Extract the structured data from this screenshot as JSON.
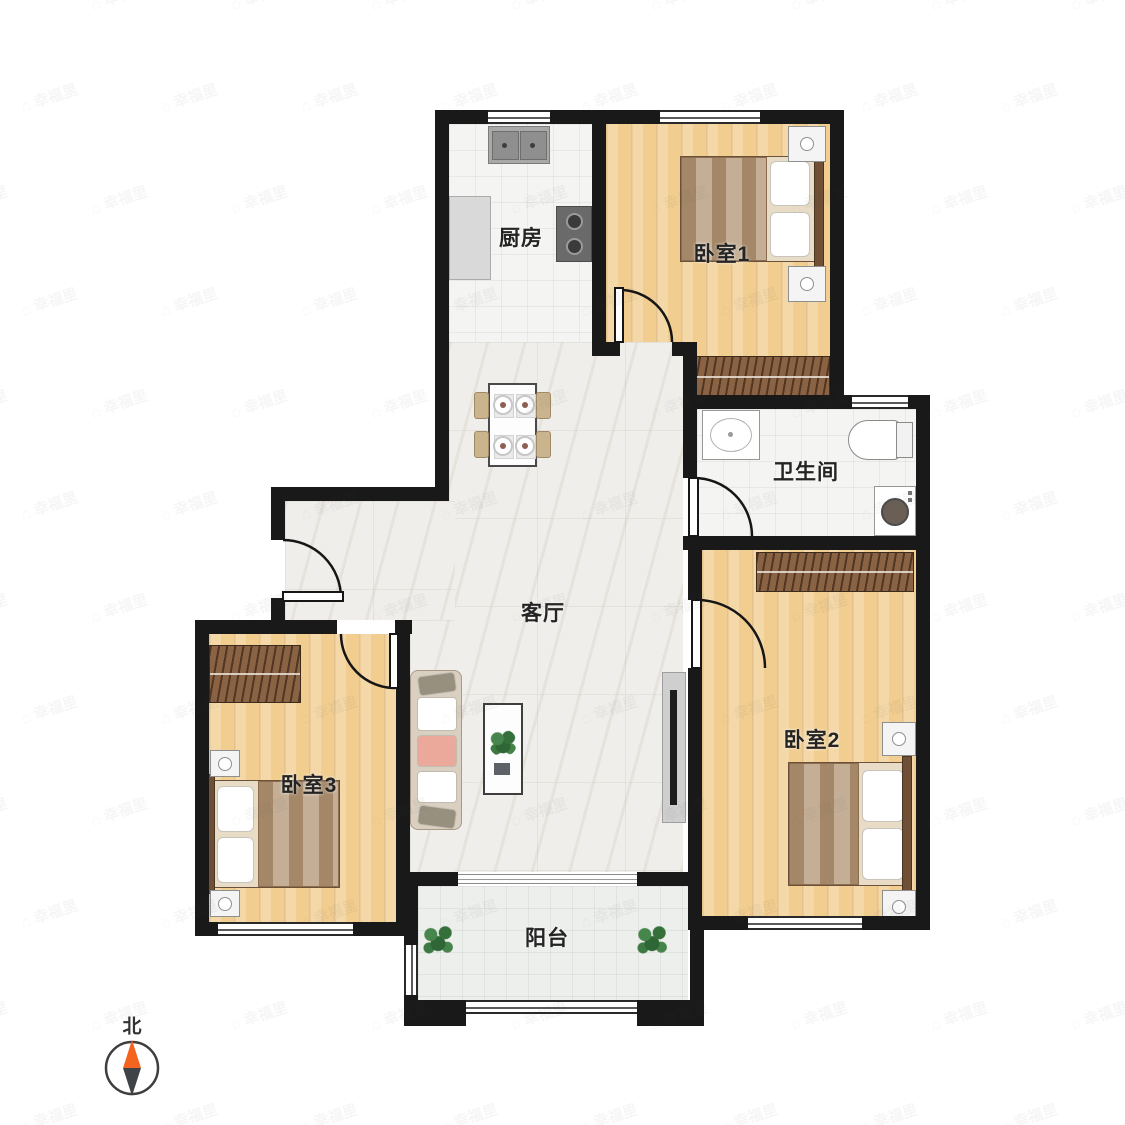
{
  "page": {
    "type": "apartment-floor-plan",
    "background": "#ffffff"
  },
  "watermark": {
    "icon": "⌂",
    "text": "幸福里"
  },
  "compass": {
    "label": "北"
  },
  "rooms": {
    "kitchen": {
      "label": "厨房"
    },
    "bedroom1": {
      "label": "卧室1"
    },
    "bathroom": {
      "label": "卫生间"
    },
    "living_room": {
      "label": "客厅"
    },
    "bedroom2": {
      "label": "卧室2"
    },
    "bedroom3": {
      "label": "卧室3"
    },
    "balcony": {
      "label": "阳台"
    }
  },
  "colors": {
    "wall": "#191919",
    "wood_floor": "#f1cd8f",
    "tile_floor": "#f4f4f2",
    "marble_floor": "#f0eeea",
    "balcony_floor": "#edefec",
    "wardrobe": "#8a6244",
    "compass_north": "#f4641e",
    "plant": "#3e7c45"
  }
}
